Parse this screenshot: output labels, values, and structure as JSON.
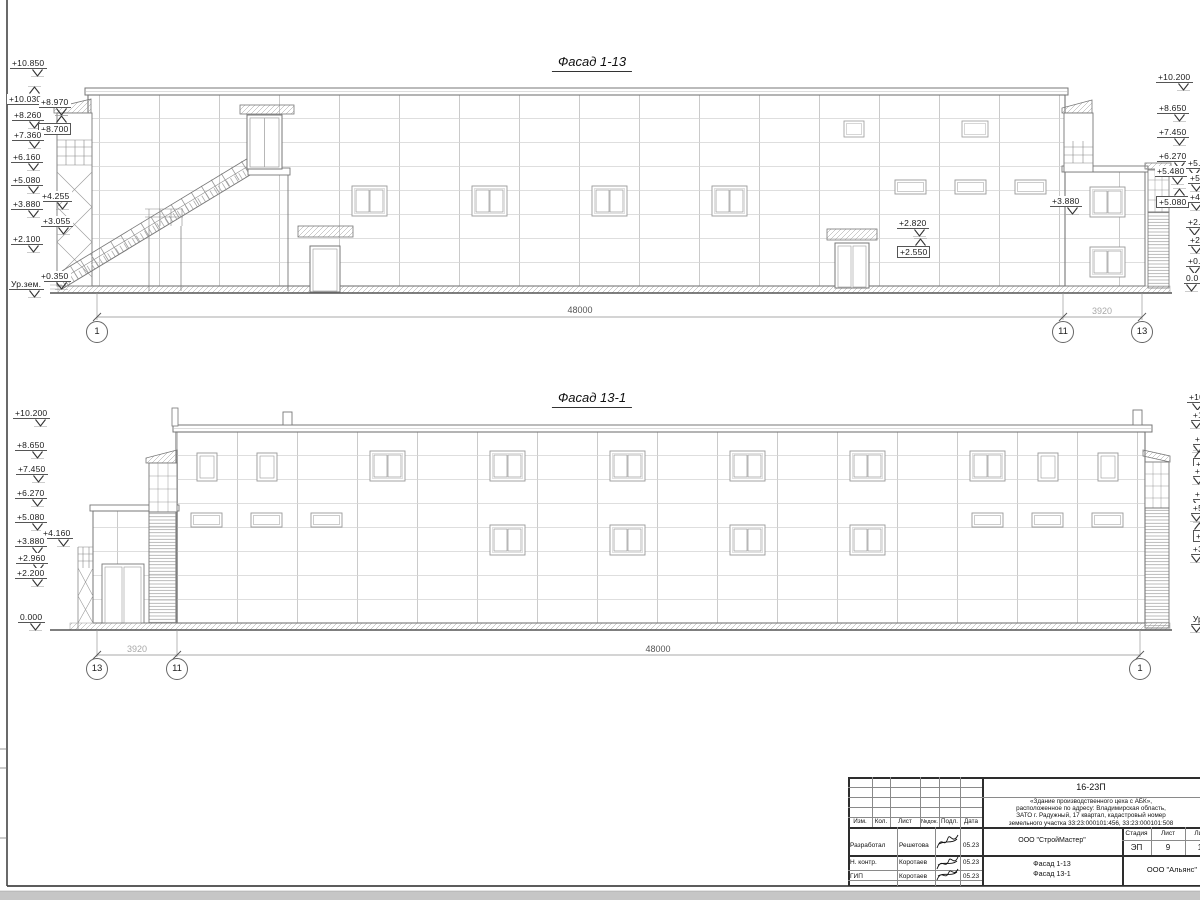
{
  "facades": [
    {
      "title": "Фасад 1-13",
      "title_x": 592,
      "title_y": 54,
      "markers": [
        {
          "t": "+10.850",
          "x": 10,
          "y": 58
        },
        {
          "t": "+10.030",
          "x": 7,
          "y": 86,
          "dir": "up"
        },
        {
          "t": "+8.970",
          "x": 39,
          "y": 97
        },
        {
          "t": "+8.260",
          "x": 12,
          "y": 110
        },
        {
          "t": "+8.700",
          "x": 38,
          "y": 115,
          "dir": "up",
          "boxed": true
        },
        {
          "t": "+7.360",
          "x": 12,
          "y": 130
        },
        {
          "t": "+6.160",
          "x": 11,
          "y": 152
        },
        {
          "t": "+5.080",
          "x": 11,
          "y": 175
        },
        {
          "t": "+4.255",
          "x": 40,
          "y": 191
        },
        {
          "t": "+3.880",
          "x": 11,
          "y": 199
        },
        {
          "t": "+3.055",
          "x": 41,
          "y": 216
        },
        {
          "t": "+2.100",
          "x": 11,
          "y": 234
        },
        {
          "t": "+0.350",
          "x": 39,
          "y": 271
        },
        {
          "t": "Ур.зем.",
          "x": 9,
          "y": 279
        },
        {
          "t": "+10.200",
          "x": 1156,
          "y": 72
        },
        {
          "t": "+8.650",
          "x": 1157,
          "y": 103
        },
        {
          "t": "+7.450",
          "x": 1157,
          "y": 127
        },
        {
          "t": "+6.270",
          "x": 1157,
          "y": 151
        },
        {
          "t": "+5.480",
          "x": 1155,
          "y": 166
        },
        {
          "t": "+5.080",
          "x": 1156,
          "y": 188,
          "dir": "up",
          "boxed": true
        },
        {
          "t": "+5.",
          "x": 1186,
          "y": 158
        },
        {
          "t": "+5.",
          "x": 1188,
          "y": 173
        },
        {
          "t": "+4.",
          "x": 1188,
          "y": 192
        },
        {
          "t": "+2.",
          "x": 1186,
          "y": 217
        },
        {
          "t": "+2.",
          "x": 1188,
          "y": 235
        },
        {
          "t": "+0.",
          "x": 1186,
          "y": 256
        },
        {
          "t": "0.0",
          "x": 1184,
          "y": 273
        },
        {
          "t": "+2.820",
          "x": 897,
          "y": 218
        },
        {
          "t": "+2.550",
          "x": 897,
          "y": 238,
          "dir": "up",
          "boxed": true
        },
        {
          "t": "+3.880",
          "x": 1050,
          "y": 196
        }
      ],
      "bubbles": [
        {
          "n": "1",
          "x": 97,
          "y": 332
        },
        {
          "n": "11",
          "x": 1063,
          "y": 332
        },
        {
          "n": "13",
          "x": 1142,
          "y": 332
        }
      ],
      "dims": [
        {
          "t": "48000",
          "x": 580,
          "y": 305
        },
        {
          "t": "3920",
          "x": 1102,
          "y": 306,
          "light": true
        }
      ]
    },
    {
      "title": "Фасад 13-1",
      "title_x": 592,
      "title_y": 390,
      "markers": [
        {
          "t": "+10.200",
          "x": 13,
          "y": 408
        },
        {
          "t": "+8.650",
          "x": 15,
          "y": 440
        },
        {
          "t": "+7.450",
          "x": 16,
          "y": 464
        },
        {
          "t": "+6.270",
          "x": 15,
          "y": 488
        },
        {
          "t": "+5.080",
          "x": 15,
          "y": 512
        },
        {
          "t": "+4.160",
          "x": 41,
          "y": 528
        },
        {
          "t": "+3.880",
          "x": 15,
          "y": 536
        },
        {
          "t": "+2.960",
          "x": 16,
          "y": 553
        },
        {
          "t": "+2.200",
          "x": 15,
          "y": 568
        },
        {
          "t": "0.000",
          "x": 18,
          "y": 612
        },
        {
          "t": "+10",
          "x": 1187,
          "y": 392
        },
        {
          "t": "+1",
          "x": 1190,
          "y": 410
        },
        {
          "t": "+8",
          "x": 1192,
          "y": 434
        },
        {
          "t": "+8",
          "x": 1193,
          "y": 450,
          "dir": "up",
          "boxed": true
        },
        {
          "t": "+7",
          "x": 1192,
          "y": 466
        },
        {
          "t": "+6",
          "x": 1192,
          "y": 489
        },
        {
          "t": "+5",
          "x": 1190,
          "y": 503
        },
        {
          "t": "+5",
          "x": 1193,
          "y": 522,
          "dir": "up",
          "boxed": true
        },
        {
          "t": "+3",
          "x": 1190,
          "y": 544
        },
        {
          "t": "Ур",
          "x": 1190,
          "y": 614
        }
      ],
      "bubbles": [
        {
          "n": "13",
          "x": 97,
          "y": 669
        },
        {
          "n": "11",
          "x": 177,
          "y": 669
        },
        {
          "n": "1",
          "x": 1140,
          "y": 669
        }
      ],
      "dims": [
        {
          "t": "3920",
          "x": 137,
          "y": 644,
          "light": true
        },
        {
          "t": "48000",
          "x": 658,
          "y": 644
        }
      ]
    }
  ],
  "title_block": {
    "code": "16-23П",
    "description_lines": [
      "«Здание производственного цеха с АБК»,",
      "расположенное по адресу: Владимирская область,",
      "ЗАТО г. Радужный, 17 квартал, кадастровый номер",
      "земельного участка 33:23:000101:456, 33:23:000101:508"
    ],
    "cols": {
      "izm": "Изм.",
      "kol": "Кол.",
      "list": "Лист",
      "ndok": "№док.",
      "podl": "Подл.",
      "data": "Дата"
    },
    "rows": [
      {
        "role": "Разработал",
        "name": "Решетова",
        "date": "05.23"
      },
      {
        "role": "Н. контр.",
        "name": "Коротаев",
        "date": "05.23"
      },
      {
        "role": "ГИП",
        "name": "Коротаев",
        "date": "05.23"
      }
    ],
    "org": "ООО \"СтройМастер\"",
    "stage_label": "Стадия",
    "sheet_label": "Лист",
    "sheets_label": "Лис",
    "stage": "ЭП",
    "sheet": "9",
    "sheets": "1",
    "subject_lines": [
      "Фасад 1-13",
      "Фасад 13-1"
    ],
    "firm": "ООО \"Альянс\""
  }
}
